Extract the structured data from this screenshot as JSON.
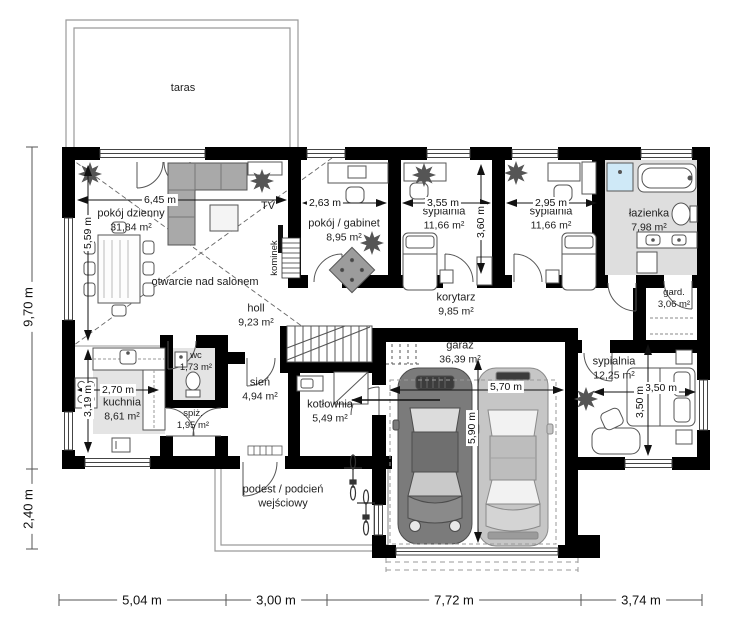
{
  "rooms": [
    {
      "name": "taras",
      "area": ""
    },
    {
      "name": "pokój dzienny",
      "area": "31,84 m²"
    },
    {
      "name": "otwarcie nad salonem",
      "area": ""
    },
    {
      "name": "pokój / gabinet",
      "area": "8,95 m²"
    },
    {
      "name": "sypialnia",
      "area": "11,66 m²"
    },
    {
      "name": "sypialnia",
      "area": "11,66 m²"
    },
    {
      "name": "łazienka",
      "area": "7,98 m²"
    },
    {
      "name": "gard.",
      "area": "3,06 m²"
    },
    {
      "name": "holl",
      "area": "9,23 m²"
    },
    {
      "name": "korytarz",
      "area": "9,85 m²"
    },
    {
      "name": "sypialnia",
      "area": "12,25 m²"
    },
    {
      "name": "wc",
      "area": "1,73 m²"
    },
    {
      "name": "kuchnia",
      "area": "8,61 m²"
    },
    {
      "name": "spiż.",
      "area": "1,95 m²"
    },
    {
      "name": "sień",
      "area": "4,94 m²"
    },
    {
      "name": "kotłownia",
      "area": "5,49 m²"
    },
    {
      "name": "garaż",
      "area": "36,39 m²"
    },
    {
      "name": "podest / podcień wejściowy",
      "area": ""
    }
  ],
  "labels": {
    "tv": "TV",
    "kominek": "kominek"
  },
  "dims": {
    "interior": {
      "living_w": "6,45 m",
      "living_h": "5,59 m",
      "office_w": "2,63 m",
      "bed1_w": "3,55 m",
      "bed1_h": "3,60 m",
      "bed2_w": "2,95 m",
      "kitchen_w": "2,70 m",
      "kitchen_h": "3,19 m",
      "garage_w": "5,70 m",
      "garage_h": "5,90 m",
      "bed3_w": "3,50 m",
      "bed3_h": "3,50 m"
    },
    "exterior": {
      "left_upper": "9,70 m",
      "left_lower": "2,40 m",
      "bottom": [
        "5,04 m",
        "3,00 m",
        "7,72 m",
        "3,74 m"
      ]
    }
  },
  "colors": {
    "wall": "#000000",
    "floor_tint": "#e4e4e4",
    "bath_floor": "#dedede",
    "shower": "#cfe9f7",
    "sofa": "#a9a9a9",
    "car_dark": "#7b7b7b",
    "car_light": "#c6c6c6"
  }
}
